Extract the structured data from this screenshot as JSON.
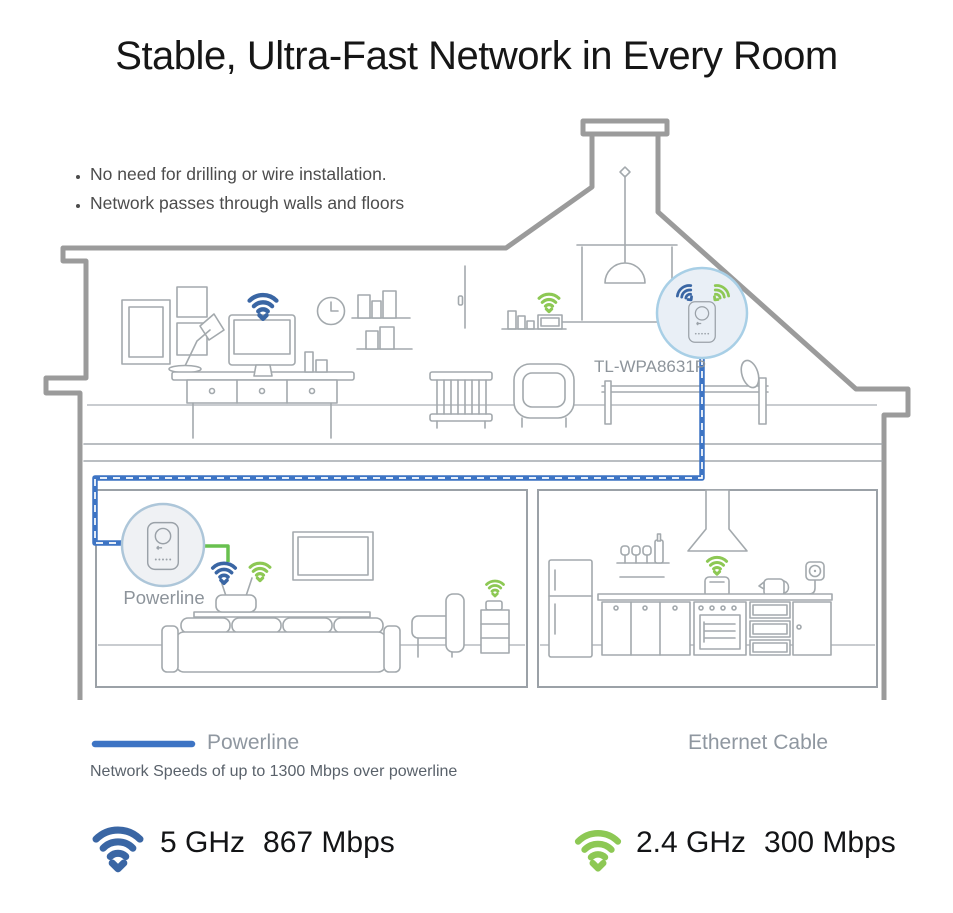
{
  "title": "Stable, Ultra-Fast Network in Every Room",
  "bullets": {
    "items": [
      "No need for drilling or wire installation.",
      "Network passes through walls and floors"
    ]
  },
  "house": {
    "extender_label": "TL-WPA8631P",
    "adapter_label": "Powerline"
  },
  "legend": {
    "powerline_label": "Powerline",
    "powerline_note": "Network Speeds of up to 1300 Mbps over powerline",
    "ethernet_label": "Ethernet Cable"
  },
  "speeds": {
    "band5": {
      "band": "5 GHz",
      "rate": "867 Mbps"
    },
    "band24": {
      "band": "2.4 GHz",
      "rate": "300 Mbps"
    }
  },
  "colors": {
    "wifi_blue": "#3a66a4",
    "wifi_green": "#8dc854",
    "powerline_cable": "#3d74c4",
    "ethernet_cable": "#68c04f",
    "ethernet_gradient_start": "#3aa33f",
    "ethernet_gradient_end": "#c3dc4e",
    "house_outline": "#9b9b9b",
    "furniture_line": "#a3a9ad"
  }
}
